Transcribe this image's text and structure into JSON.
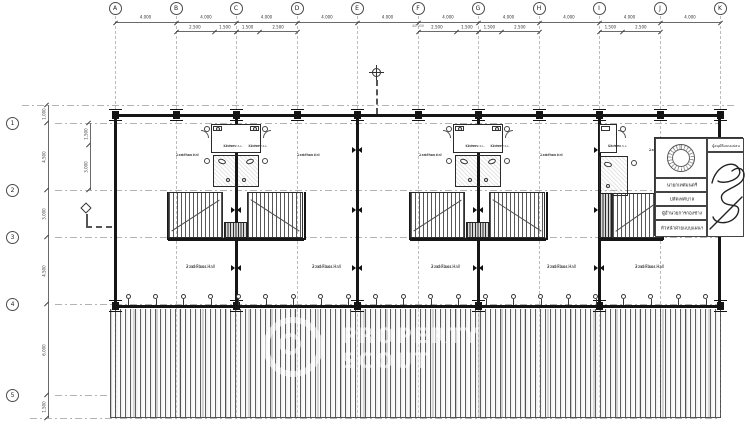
{
  "page": {
    "background": "#ffffff",
    "line_ink": "#1a1a1a",
    "hatch_gray": "#5f5f5f"
  },
  "grid": {
    "columns": [
      "A",
      "B",
      "C",
      "D",
      "E",
      "F",
      "G",
      "H",
      "I",
      "J",
      "K"
    ],
    "rows": [
      "1",
      "2",
      "3",
      "4",
      "5"
    ]
  },
  "dimensions": {
    "top_main": [
      "4.000",
      "4.000",
      "4.000",
      "4.000",
      "4.000",
      "4.000",
      "4.000",
      "4.000",
      "4.000",
      "4.000"
    ],
    "top_overall": "40.000",
    "top_sub": [
      "2.500",
      "1.500",
      "1.500",
      "2.500",
      "2.500",
      "1.500",
      "1.500",
      "2.500",
      "1.500",
      "2.500"
    ],
    "left_main": [
      "1.000",
      "4.500",
      "3.000",
      "4.500",
      "6.000",
      "1.500"
    ],
    "left_sub": [
      "1.500",
      "3.000"
    ]
  },
  "rooms": {
    "hall_label": "2 nd Floor Hall",
    "hall_level": "+2.80 F.2.S.L.",
    "kitchen_label": "Kitchen",
    "kitchen_level": "+2.78 F.2.S.L."
  },
  "title_block": {
    "approval_label": "ผู้อนุมัติแบบแปลน",
    "signatory_rows": [
      "นายกเทศมนตรี",
      "ปลัดเทศบาล",
      "ผู้อำนวยการกองช่าง",
      "หัวหน้าฝ่ายแบบแผนฯ"
    ]
  },
  "watermark": {
    "line1": "PROPERTY",
    "line2": "SCOUT"
  }
}
